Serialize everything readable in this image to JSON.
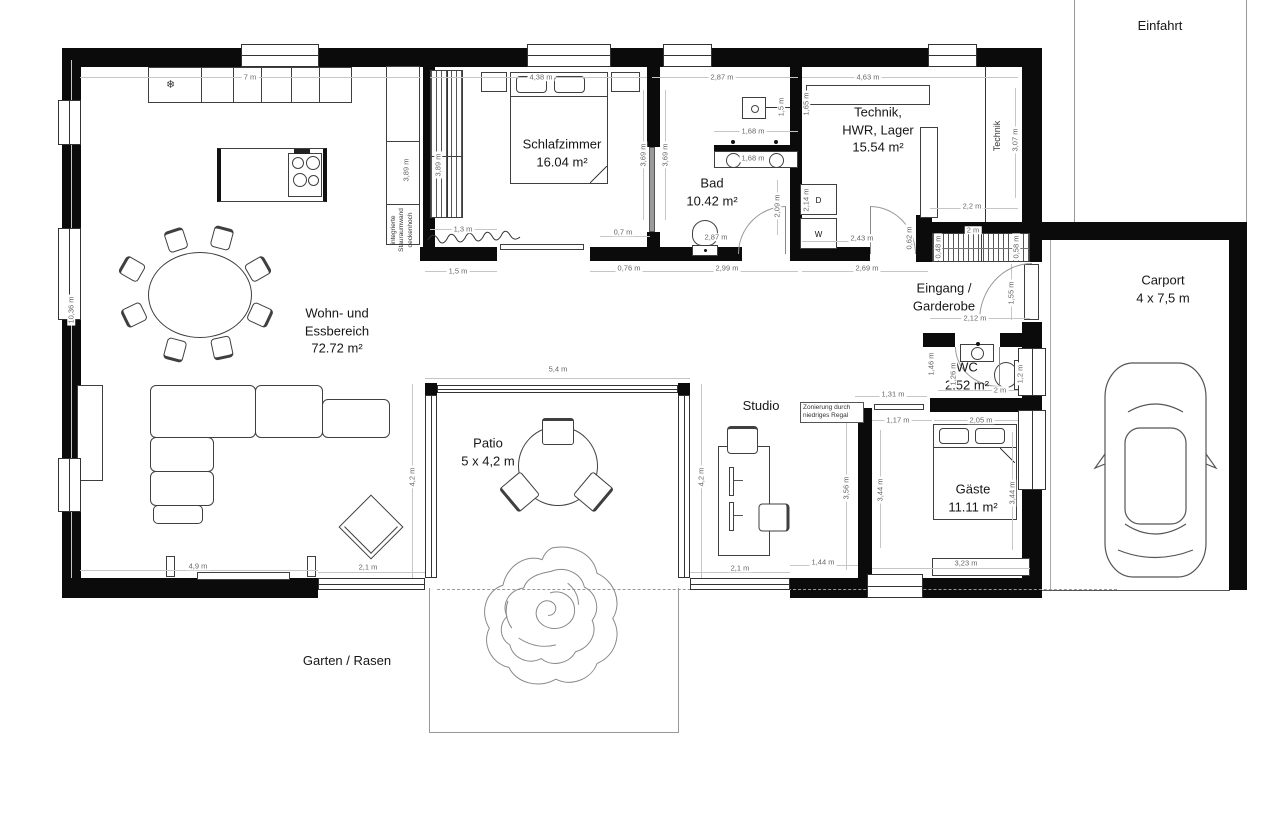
{
  "rooms": {
    "schlafzimmer": {
      "name": "Schlafzimmer",
      "area": "16.04 m²"
    },
    "bad": {
      "name": "Bad",
      "area": "10.42 m²"
    },
    "technik": {
      "name": "Technik,\nHWR, Lager",
      "area": "15.54 m²"
    },
    "eingang": {
      "name": "Eingang /\nGarderobe"
    },
    "wc": {
      "name": "WC",
      "area": "2.52 m²"
    },
    "gaeste": {
      "name": "Gäste",
      "area": "11.11 m²"
    },
    "studio": {
      "name": "Studio"
    },
    "wohnen": {
      "name": "Wohn- und\nEssbereich",
      "area": "72.72 m²"
    }
  },
  "outdoor": {
    "einfahrt": "Einfahrt",
    "carport_name": "Carport",
    "carport_size": "4 x 7,5 m",
    "patio_name": "Patio",
    "patio_size": "5 x 4,2 m",
    "garten": "Garten / Rasen"
  },
  "annotations": {
    "stauraumwand": "integrierte\nStauraumwand\ndeckenhoch",
    "zonierung": "Zonierung durch\nniedriges Regal",
    "technik_schacht": "Technik",
    "dryer": "D",
    "washer": "W",
    "fridge": "❄"
  },
  "dimensions": {
    "top_kitchen": "7 m",
    "top_schlafzimmer": "4,38 m",
    "top_bad": "2,87 m",
    "top_technik": "4,63 m",
    "left_wohnbereich": "10,36 m",
    "stauraumwand_hoehe": "3,89 m",
    "schrank_hoehe": "3,89 m",
    "schrank_breite": "1,3 m",
    "schrank_breite2": "1,5 m",
    "schlafzimmer_wand": "3,69 m",
    "bad_wand": "3,69 m",
    "tuer_schlafzimmer": "0,7 m",
    "tuer_schlafzimmer2": "0,76 m",
    "bad_breite": "2,99 m",
    "waschtisch": "1,68 m",
    "waschtisch2": "1,68 m",
    "dusche": "1,5 m",
    "bad_rechts": "1,65 m",
    "bad_tuer": "2,09 m",
    "bad_unten": "2,87 m",
    "hwr_geraete": "2,14 m",
    "hwr_tuer": "2,43 m",
    "hwr_tuer2": "0,62 m",
    "hwr_unten": "2,69 m",
    "hwr_regal": "2,2 m",
    "technik_schacht_hoehe": "3,07 m",
    "garderobe": "2 m",
    "garderobe_links": "0,48 m",
    "garderobe_rechts": "0,58 m",
    "eingang_breite": "2,12 m",
    "eingang_tuer": "1,55 m",
    "wc_links": "1,46 m",
    "wc_links2": "1,26 m",
    "wc_rechts": "1,2 m",
    "wc_breite": "2 m",
    "flur": "1,31 m",
    "gaeste_oben": "1,17 m",
    "gaeste_bett": "2,05 m",
    "gaeste_links": "3,44 m",
    "gaeste_rechts": "3,44 m",
    "regal_wand": "3,56 m",
    "gaeste_unten": "3,23 m",
    "flur_unten": "1,44 m",
    "studio_unten": "2,1 m",
    "sessel": "2,1 m",
    "wohnzimmer_unten": "4,9 m",
    "patio_breite": "5,4 m",
    "patio_links": "4,2 m",
    "patio_rechts": "4,2 m"
  }
}
